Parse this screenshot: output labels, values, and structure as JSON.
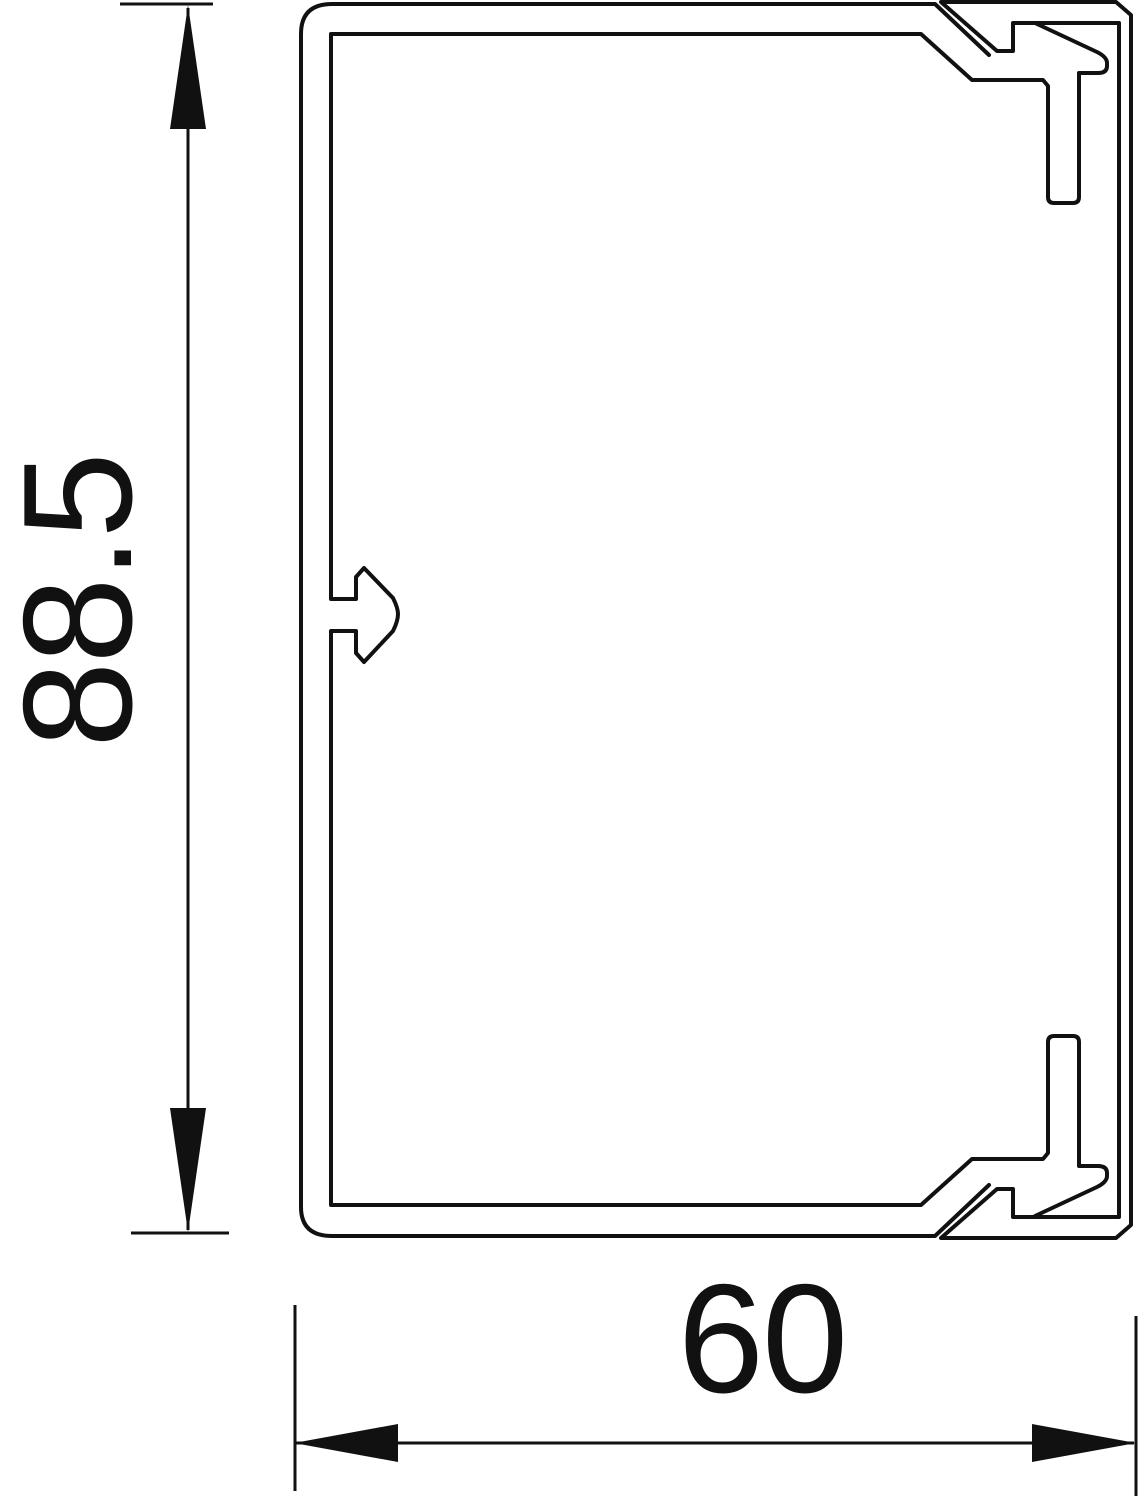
{
  "diagram": {
    "kind": "cable-trunking-cross-section",
    "background_color": "#ffffff",
    "line_color": "#111111",
    "dimensions": {
      "height": {
        "label": "88.5"
      },
      "width": {
        "label": "60"
      }
    }
  }
}
